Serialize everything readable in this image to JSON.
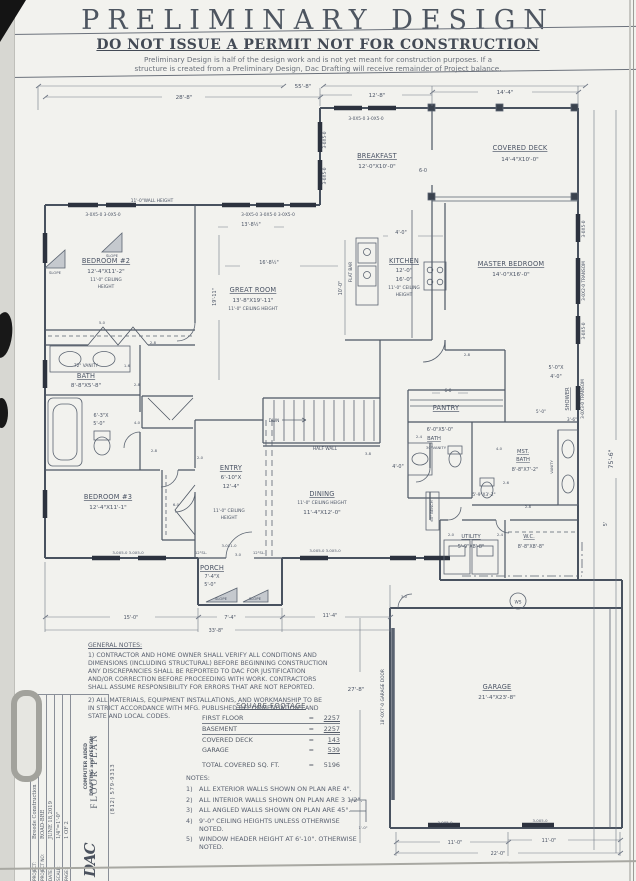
{
  "colors": {
    "ink": "#4a5364",
    "paper": "#f2f2ee",
    "window": "#2c323e"
  },
  "header": {
    "title": "PRELIMINARY DESIGN",
    "subtitle": "DO NOT ISSUE A PERMIT NOT FOR CONSTRUCTION",
    "disclaimer1": "Preliminary Design is half of the design work and is not yet meant for construction purposes.  If a",
    "disclaimer2": "structure is created from a Preliminary Design, Dac Drafting will receive remainder of Project balance."
  },
  "rooms": {
    "breakfast": {
      "name": "BREAKFAST",
      "dims": "12'-0\"X10'-0\""
    },
    "covered_deck": {
      "name": "COVERED DECK",
      "dims": "14'-4\"X10'-0\""
    },
    "bedroom2": {
      "name": "BEDROOM #2",
      "dims": "12'-4\"X11'-2\"",
      "note1": "11'-0\" CEILING",
      "note2": "HEIGHT"
    },
    "great_room": {
      "name": "GREAT ROOM",
      "dims": "13'-8\"X19'-11\"",
      "note1": "11'-0\" CEILING HEIGHT"
    },
    "kitchen": {
      "name": "KITCHEN",
      "dim1": "12'-0\"",
      "dim2": "16'-0\"",
      "note1": "11'-0\" CEILING",
      "note2": "HEIGHT"
    },
    "master": {
      "name": "MASTER BEDROOM",
      "dims": "14'-0\"X16'-0\""
    },
    "bath": {
      "name": "BATH",
      "dims": "8'-8\"X5'-8\""
    },
    "bath_tub": {
      "dim1": "6'-3\"X",
      "dim2": "5'-0\""
    },
    "bedroom3": {
      "name": "BEDROOM #3",
      "dims": "12'-4\"X11'-1\""
    },
    "entry": {
      "name": "ENTRY",
      "dim1": "6'-10\"X",
      "dim2": "12'-4\"",
      "note1": "11'-0\" CEILING",
      "note2": "HEIGHT"
    },
    "dining": {
      "name": "DINING",
      "note1": "11'-0\" CEILING HEIGHT",
      "dims": "11'-4\"X12'-0\""
    },
    "pantry": {
      "name": "PANTRY"
    },
    "bath2": {
      "dims": "6'-0\"X5'-0\"",
      "name": "BATH"
    },
    "mst_bath": {
      "name1": "MST.",
      "name2": "BATH",
      "dims": "8'-8\"X7'-2\""
    },
    "shower": {
      "name": "SHOWER",
      "dim1": "5'-0\"X",
      "dim2": "4'-0\""
    },
    "utility": {
      "name": "UTILITY",
      "dims": "5'-9\"X8'-8\""
    },
    "wc": {
      "name": "W.C.",
      "dims": "8'-8\"X8'-8\""
    },
    "porch": {
      "name": "PORCH",
      "dim1": "7'-4\"X",
      "dim2": "5'-0\""
    },
    "garage": {
      "name": "GARAGE",
      "dims": "21'-4\"X23'-8\""
    }
  },
  "labels": {
    "wall_height": "11'-0\"WALL HEIGHT",
    "half_wall": "HALF WALL",
    "dwn": "DWN",
    "flat_bar": "FLAT BAR",
    "slope": "SLOPE",
    "vanity72": "72\" VANITY",
    "vanity30": "30\"VANITY",
    "vanity": "VANITY",
    "bench60": "60\" BENCH",
    "ws": "WS",
    "garage_door": "18'-0X7'-0 GARAGE DOOR",
    "sl12": "12\"SL.",
    "win": "3-0X5-0",
    "win2": "3-0X5-0  3-0X5-0",
    "win3": "3-0X5-0 3-0X5-0 3-0X5-0",
    "transom": "3-0X2-0 TRANSOM",
    "transom2": "3-0X3-0 TRANSOM",
    "win3010": "3-0X1-0"
  },
  "dims": {
    "d55_8": "55'-8\"",
    "d28_8": "28'-8\"",
    "d12_8": "12'-8\"",
    "d14_4": "14'-4\"",
    "d13_8h": "13'-8½\"",
    "d16_8h": "16'-8½\"",
    "d10_0": "10'-0\"",
    "d4_0": "4'-0\"",
    "d19_11": "19'-11\"",
    "d75_6": "75'-6\"",
    "d5": "5'",
    "d3_8": "3-8",
    "d15_0": "15'-0\"",
    "d7_4": "7'-4\"",
    "d11_4": "11'-4\"",
    "d33_8": "33'-8\"",
    "d27_8": "27'-8\"",
    "d11_0": "11'-0\"",
    "d22_0": "22'-0\"",
    "d1_0": "1'-0\"",
    "d6_0": "6-0",
    "d5_0": "5-0",
    "d4_0d": "4-0",
    "d3_0": "3-0",
    "d2_8": "2-8",
    "d2_6": "2-6",
    "d2_4": "2-4",
    "d2_0": "2-0",
    "d1_6": "1-6",
    "d5_9x3_2": "5'-9\"X3'-2\"",
    "d5_0q": "5'-0\"",
    "d3_6": "3'-6\""
  },
  "general_notes": {
    "title": "GENERAL NOTES:",
    "p1": "1) CONTRACTOR AND HOME OWNER SHALL VERIFY ALL CONDITIONS AND DIMENSIONS (INCLUDING STRUCTURAL) BEFORE BEGINNING CONSTRUCTION ANY DISCREPANCIES SHALL BE REPORTED TO DAC FOR JUSTIFICATION AND/OR CORRECTION BEFORE PROCEEDING WITH WORK.  CONTRACTORS SHALL ASSUME RESPONSIBILITY FOR ERRORS THAT ARE NOT REPORTED.",
    "p2": "2) ALL MATERIALS, EQUIPMENT INSTALLATIONS, AND WORKMANSHIP TO BE IN STRICT ACCORDANCE WITH MFG. PUBLISHED RECOMMENDATIONS AND STATE AND LOCAL CODES."
  },
  "square_footage": {
    "title": "SQUARE FOOTAGE",
    "rows": [
      {
        "label": "FIRST FLOOR",
        "eq": "=",
        "value": "2257"
      },
      {
        "label": "BASEMENT",
        "eq": "=",
        "value": "2257"
      },
      {
        "label": "COVERED DECK",
        "eq": "=",
        "value": "143"
      },
      {
        "label": "GARAGE",
        "eq": "=",
        "value": "539"
      }
    ],
    "total_label": "TOTAL COVERED SQ. FT.",
    "total_eq": "=",
    "total_value": "5196"
  },
  "notes": {
    "title": "NOTES:",
    "items": [
      {
        "n": "1)",
        "t": "ALL EXTERIOR WALLS SHOWN ON PLAN ARE 4\"."
      },
      {
        "n": "2)",
        "t": "ALL INTERIOR WALLS SHOWN ON PLAN ARE 3 1/2\"."
      },
      {
        "n": "3)",
        "t": "ALL ANGLED WALLS SHOWN ON PLAN ARE 45°."
      },
      {
        "n": "4)",
        "t": "9'-0\" CEILING HEIGHTS UNLESS OTHERWISE NOTED."
      },
      {
        "n": "5)",
        "t": "WINDOW HEADER HEIGHT AT 6'-10\". OTHERWISE NOTED."
      }
    ]
  },
  "titleblock": {
    "logo": "DAC",
    "company1": "COMPUTER AIDED",
    "company2": "DRAFTING and DESIGN",
    "phone": "(812) 579-9313",
    "fields": [
      {
        "label": "PROJECT:",
        "value": "Breede Construction"
      },
      {
        "label": "PROJECT NO:",
        "value": "ROAD-BRE"
      },
      {
        "label": "DATE:",
        "value": "JUNE 18,2019"
      },
      {
        "label": "SCALE:",
        "value": "1/4\"=1'-0\""
      },
      {
        "label": "PAGE:",
        "value": "1 OF 2"
      }
    ],
    "sheet_title": "FLOOR PLAN"
  }
}
